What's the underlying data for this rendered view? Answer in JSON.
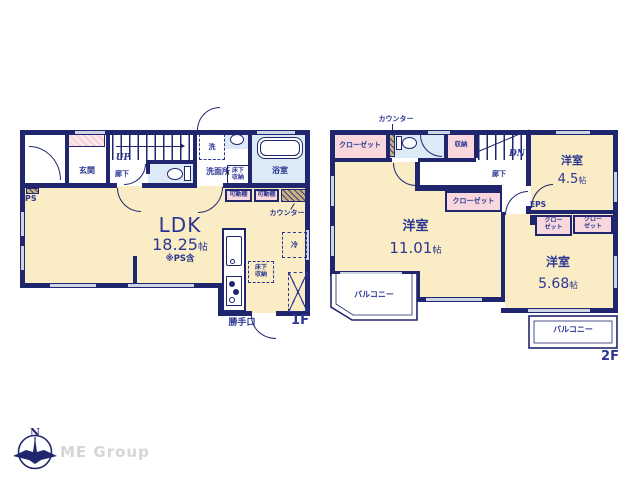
{
  "colors": {
    "wall_navy": "#20266e",
    "text_navy": "#2b3692",
    "room_cream": "#faecc5",
    "closet_pink": "#f8d8dc",
    "bath_blue": "#dceaf7",
    "counter_tan": "#c9b186",
    "window_gray": "#ccd5e4",
    "logo_gray": "#d6d6d6"
  },
  "logo": {
    "north": "N",
    "company": "ME Group"
  },
  "floor1": {
    "label": "1F",
    "entrance": "玄関",
    "up": "UP",
    "hallway": "廊下",
    "washer": "洗",
    "washroom": "洗面所",
    "underfloor_storage_l1": "床下",
    "underfloor_storage_l2": "収納",
    "bathroom": "浴室",
    "movable_shelf_1": "可動棚",
    "movable_shelf_2": "可動棚",
    "counter": "カウンター",
    "ps": "PS",
    "ldk_name": "LDK",
    "ldk_size": "18.25",
    "ldk_size_unit": "帖",
    "ldk_note": "※PS含",
    "fridge": "冷",
    "kitchen_underfloor_l1": "床下",
    "kitchen_underfloor_l2": "収納",
    "back_door": "勝手口"
  },
  "floor2": {
    "label": "2F",
    "counter": "カウンター",
    "closet_large": "クローゼット",
    "storage": "収納",
    "dn": "DN",
    "hallway": "廊下",
    "room_45_name": "洋室",
    "room_45_size": "4.5",
    "room_45_unit": "帖",
    "eps": "EPS",
    "closet_small_1_l1": "クロー",
    "closet_small_1_l2": "ゼット",
    "closet_small_2_l1": "クロー",
    "closet_small_2_l2": "ゼット",
    "closet_mid": "クローゼット",
    "room_1101_name": "洋室",
    "room_1101_size": "11.01",
    "room_1101_unit": "帖",
    "room_568_name": "洋室",
    "room_568_size": "5.68",
    "room_568_unit": "帖",
    "balcony_left": "バルコニー",
    "balcony_right": "バルコニー"
  }
}
